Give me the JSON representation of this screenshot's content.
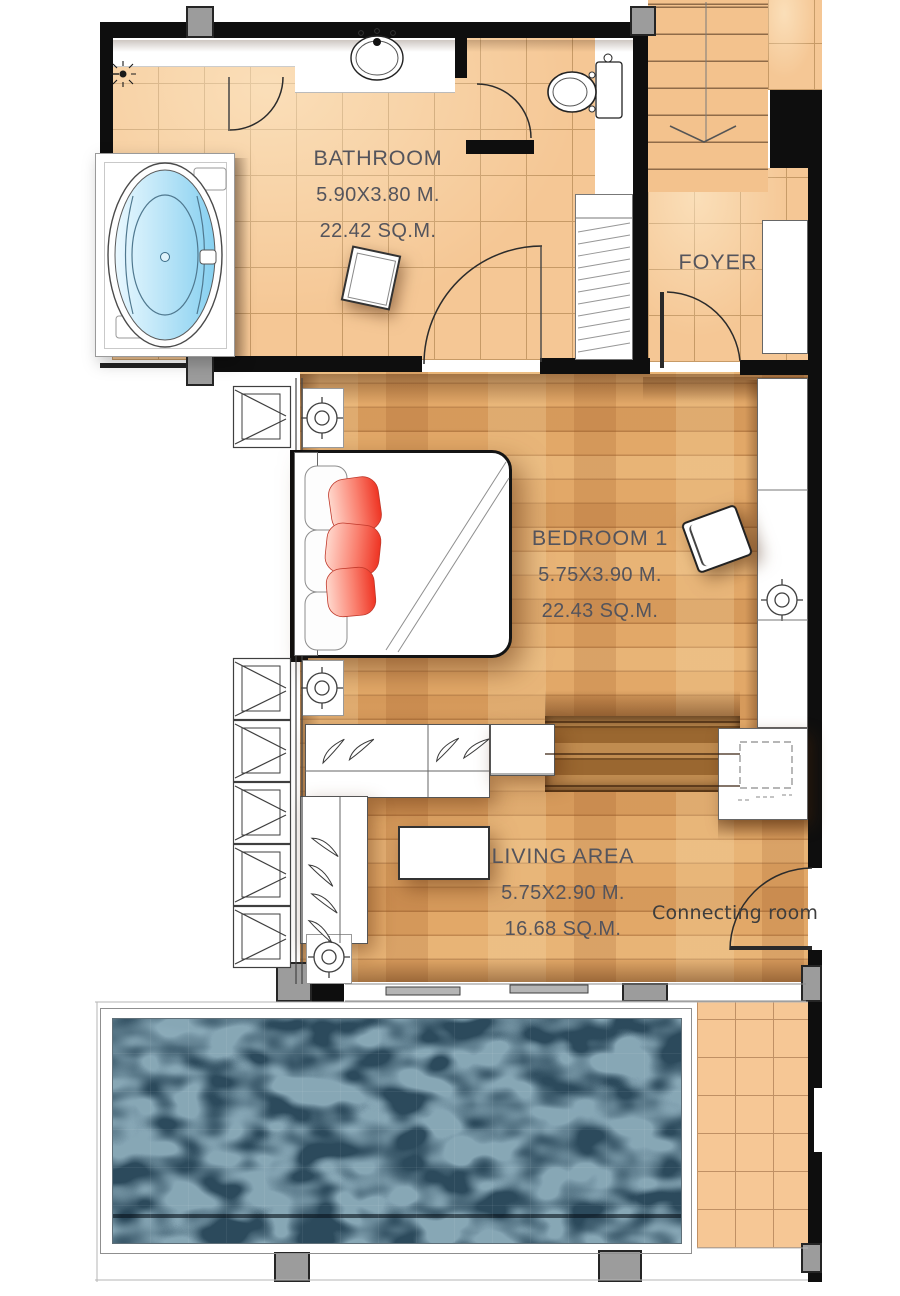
{
  "plan": {
    "rooms": {
      "bathroom": {
        "name": "BATHROOM",
        "dimensions": "5.90X3.80 M.",
        "area": "22.42 SQ.M."
      },
      "foyer": {
        "name": "FOYER"
      },
      "bedroom1": {
        "name": "BEDROOM 1",
        "dimensions": "5.75X3.90 M.",
        "area": "22.43 SQ.M."
      },
      "living_area": {
        "name": "LIVING AREA",
        "dimensions": "5.75X2.90 M.",
        "area": "16.68 SQ.M."
      }
    },
    "annotations": {
      "connecting_room_label": "Connecting room d"
    },
    "fixtures": [
      "bathtub-jacuzzi",
      "wash-basin",
      "toilet",
      "shower-head",
      "staircase-down",
      "shelving-unit",
      "foyer-closet",
      "double-bed",
      "red-pillows",
      "armchair",
      "stool",
      "wardrobe",
      "built-in-counter",
      "l-shaped-sofa",
      "coffee-table",
      "louvre-windows",
      "sliding-glass-doors",
      "connecting-door",
      "swimming-pool",
      "pool-terrace"
    ],
    "colors": {
      "wall": "#0e0e0e",
      "tile_floor": "#f5c795",
      "wood_floor": "#e2a868",
      "steps": "#b9834a",
      "pool_water": "#2c4a5c",
      "tub_water": "#9fd9f4",
      "pillow_red": "#ee3423",
      "column_gray": "#9c9c9c",
      "label_text": "#54545c"
    }
  }
}
